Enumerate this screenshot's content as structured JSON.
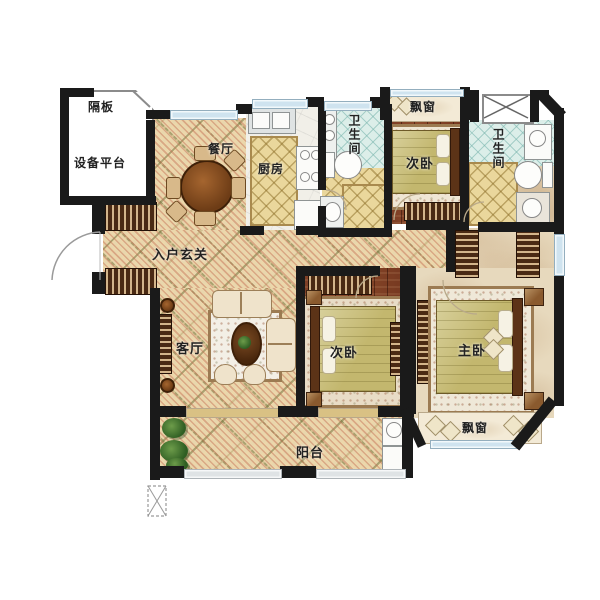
{
  "title": "apartment-floor-plan",
  "labels": {
    "partition_board": "隔板",
    "equipment_platform": "设备平台",
    "dining_room": "餐厅",
    "kitchen": "厨房",
    "bathroom_1": "卫生间",
    "bathroom_2": "卫生间",
    "bedroom_top": "次卧",
    "bedroom_middle": "次卧",
    "master_bedroom": "主卧",
    "entry_foyer": "入户玄关",
    "living_room": "客厅",
    "balcony": "阳台",
    "bay_window_top": "飘窗",
    "bay_window_bottom": "飘窗"
  },
  "colors": {
    "wall": "#1a1a1a",
    "tile_floor": "#e9d6ac",
    "wood_floor": "#80402a",
    "marble_floor": "#e7d9bd",
    "window_glass": "#cfe3ef",
    "label_text": "#222222"
  }
}
